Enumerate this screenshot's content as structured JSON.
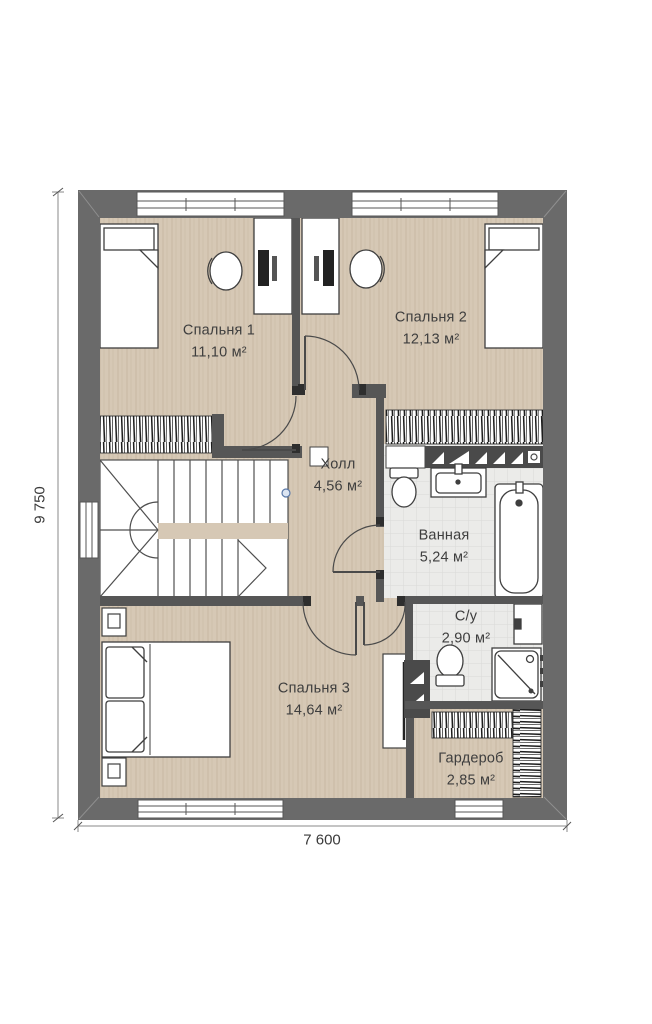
{
  "plan": {
    "type": "floor-plan",
    "rooms": [
      {
        "id": "bedroom-1",
        "name": "Спальня 1",
        "area": "11,10 м²"
      },
      {
        "id": "bedroom-2",
        "name": "Спальня 2",
        "area": "12,13 м²"
      },
      {
        "id": "hall",
        "name": "Холл",
        "area": "4,56 м²"
      },
      {
        "id": "bathroom",
        "name": "Ванная",
        "area": "5,24 м²"
      },
      {
        "id": "wc",
        "name": "С/у",
        "area": "2,90 м²"
      },
      {
        "id": "bedroom-3",
        "name": "Спальня 3",
        "area": "14,64 м²"
      },
      {
        "id": "wardrobe",
        "name": "Гардероб",
        "area": "2,85 м²"
      }
    ],
    "dimensions": {
      "overall_width": "7 600",
      "overall_height": "9 750"
    },
    "colors": {
      "outer_wall": "#6a6a6a",
      "inner_wall": "#565656",
      "floor_wood": "#d6c8b5",
      "floor_tile": "#ebebe9",
      "furniture_line": "#3f3f3f",
      "dimension_line": "#8a8a8a"
    }
  }
}
